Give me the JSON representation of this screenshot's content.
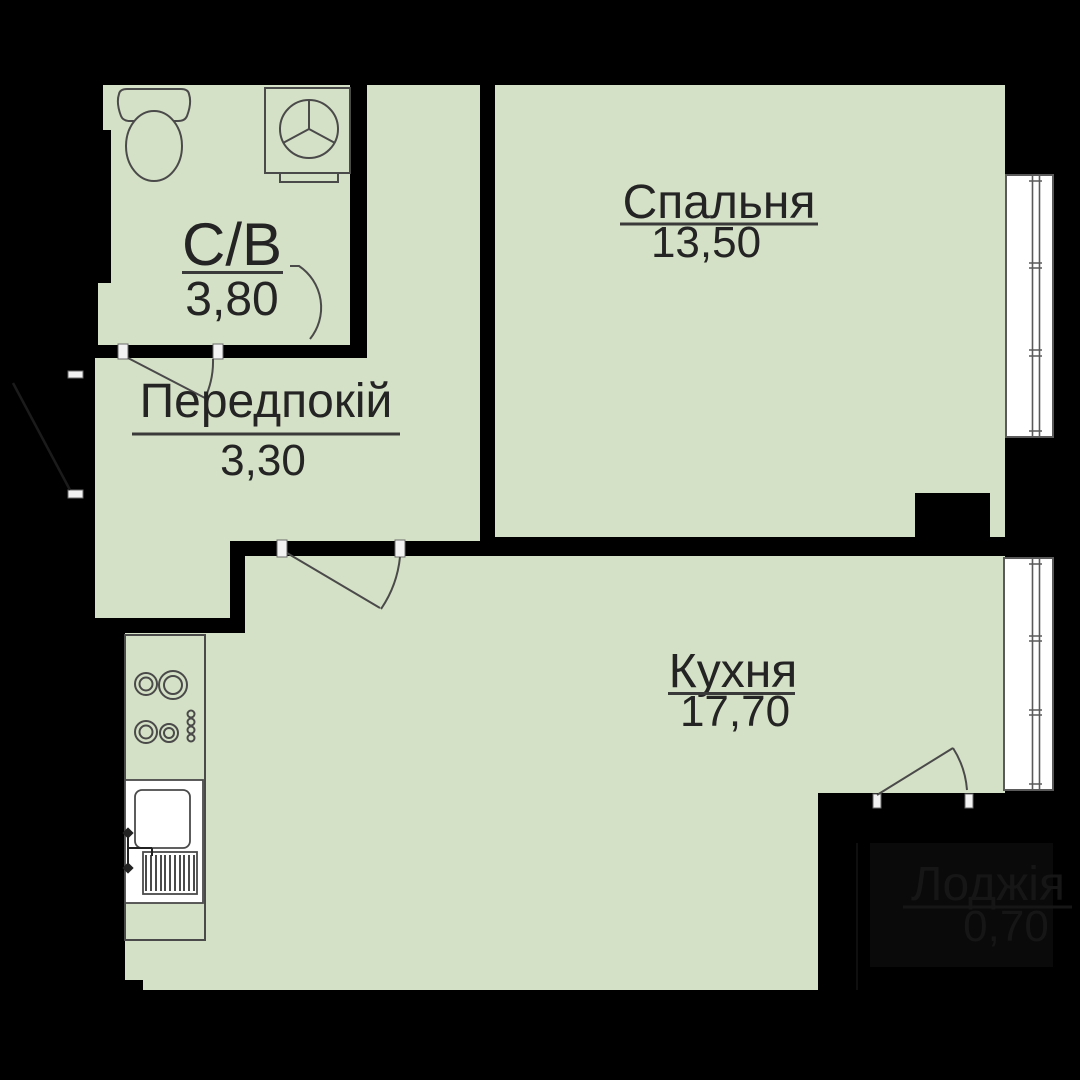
{
  "plan": {
    "colors": {
      "background": "#000000",
      "floor": "#d5e1c6",
      "outline": "#4a4a4a",
      "window_fill": "#ffffff",
      "window_stroke": "#5a5a5a",
      "jamb_fill": "#f2f2f2",
      "text": "#242424",
      "underline": "#3a3a3a",
      "loggia_dim_fill": "#0a0a0a",
      "loggia_text": "#161616"
    },
    "rooms": [
      {
        "id": "bathroom",
        "label": "С/В",
        "area": "3,80"
      },
      {
        "id": "bedroom",
        "label": "Спальня",
        "area": "13,50"
      },
      {
        "id": "hallway",
        "label": "Передпокій",
        "area": "3,30"
      },
      {
        "id": "kitchen",
        "label": "Кухня",
        "area": "17,70"
      },
      {
        "id": "loggia",
        "label": "Лоджія",
        "area": "0,70"
      }
    ],
    "icons": {
      "toilet": "toilet-icon",
      "washing_machine": "washing-machine-icon",
      "stove": "stove-burners-icon",
      "sink": "kitchen-sink-icon",
      "window": "window-icon",
      "door_swing": "door-swing-icon"
    }
  }
}
